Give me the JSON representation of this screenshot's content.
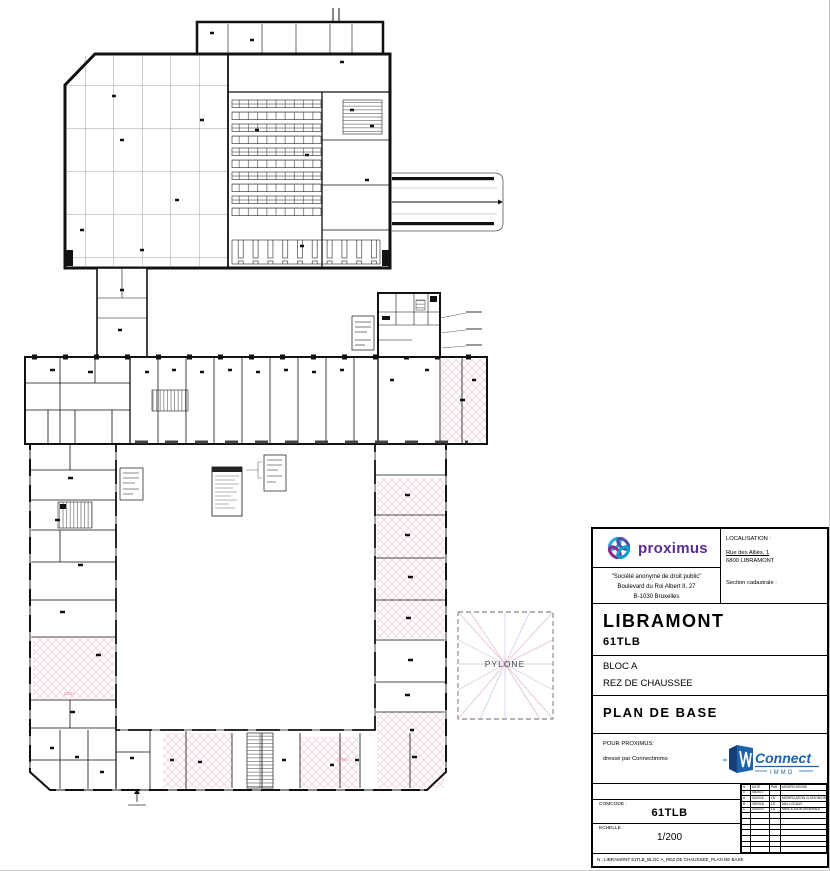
{
  "plan": {
    "pylone_label": "PYLONE",
    "room_label_1": "12034",
    "room_label_2": "12604"
  },
  "title_block": {
    "brand": "proximus",
    "localisation_label": "LOCALISATION :",
    "address_line1": "Rue des Alliés, 1",
    "address_line2": "6800 LIBRAMONT",
    "cadastre_label": "Section cadastrale :",
    "company_line1": "\"Société anonyme de droit public\"",
    "company_line2": "Boulevard du Roi Albert II, 27",
    "company_line3": "B-1030 Bruxelles",
    "site_name": "LIBRAMONT",
    "site_code": "61TLB",
    "bloc": "BLOC A",
    "level": "REZ DE CHAUSSEE",
    "doc_title": "PLAN DE BASE",
    "pour_label": "POUR PROXIMUS:",
    "dresse_label": "dressé par Connectimmo",
    "connect_brand": "Connect",
    "connect_sub": "IMMO",
    "comcode_label": "COMCODE :",
    "comcode_value": "61TLB",
    "echelle_label": "ECHELLE :",
    "echelle_value": "1/200",
    "footnote": "N : LIBRAMONT 61TLB_BLOC A_REZ DE CHAUSSEE_PLAN DE BASE",
    "revisions": {
      "headers": [
        "N",
        "DATE",
        "PAR",
        "MODIFICATIONS"
      ],
      "rows": [
        [
          "0",
          "05/2017",
          "",
          ""
        ],
        [
          "A",
          "03/2018",
          "LD",
          "MODIFICATION CLOISONS BLOC A"
        ],
        [
          "B",
          "09/2018",
          "LD",
          "MAJ LOCAUX"
        ],
        [
          "C",
          "03/2019",
          "LD",
          "MISE A JOUR GENERALE"
        ],
        [
          "",
          "",
          "",
          ""
        ],
        [
          "",
          "",
          "",
          ""
        ],
        [
          "",
          "",
          "",
          ""
        ],
        [
          "",
          "",
          "",
          ""
        ],
        [
          "",
          "",
          "",
          ""
        ],
        [
          "",
          "",
          "",
          ""
        ],
        [
          "",
          "",
          "",
          ""
        ]
      ]
    }
  },
  "colors": {
    "proximus_purple": "#5C2D91",
    "connect_blue": "#1B63AD",
    "hatch_pink": "#F0CFDB",
    "room_label_pink": "#E080B0"
  }
}
